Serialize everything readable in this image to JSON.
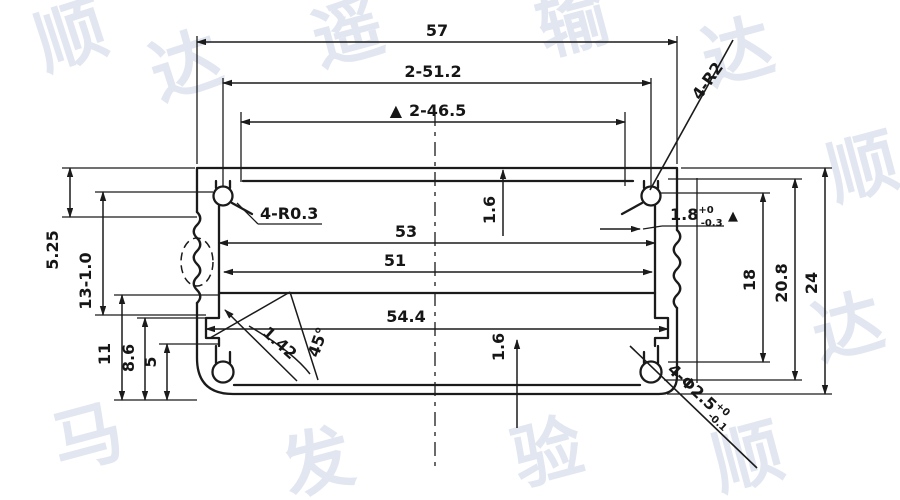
{
  "drawing": {
    "ink_color": "#1b1b1b",
    "watermark_color": "#e2e6f0",
    "dims": {
      "w57": "57",
      "w512": "2-51.2",
      "w465": "2-46.5",
      "tri": "▲",
      "r2": "4-R2",
      "slot": {
        "base": "1.8",
        "sup": "+0",
        "sub": "-0.3"
      },
      "fillet": "4-R0.3",
      "w53": "53",
      "w51": "51",
      "w544": "54.4",
      "t16top": "1.6",
      "t16bot": "1.6",
      "ang45": "45°",
      "ch142": "1.42",
      "l525": "5.25",
      "l13": "13-1.0",
      "l11": "11",
      "l86": "8.6",
      "l5": "5",
      "r18": "18",
      "r208": "20.8",
      "r24": "24",
      "hole": {
        "base": "4-Φ2.5",
        "sup": "+0",
        "sub": "-0.1"
      }
    },
    "watermark": [
      {
        "ch": "顺"
      },
      {
        "ch": "达"
      },
      {
        "ch": "遥"
      },
      {
        "ch": "输"
      },
      {
        "ch": "达"
      },
      {
        "ch": "顺"
      },
      {
        "ch": "达"
      },
      {
        "ch": "马"
      },
      {
        "ch": "发"
      },
      {
        "ch": "验"
      },
      {
        "ch": "顺"
      }
    ]
  }
}
